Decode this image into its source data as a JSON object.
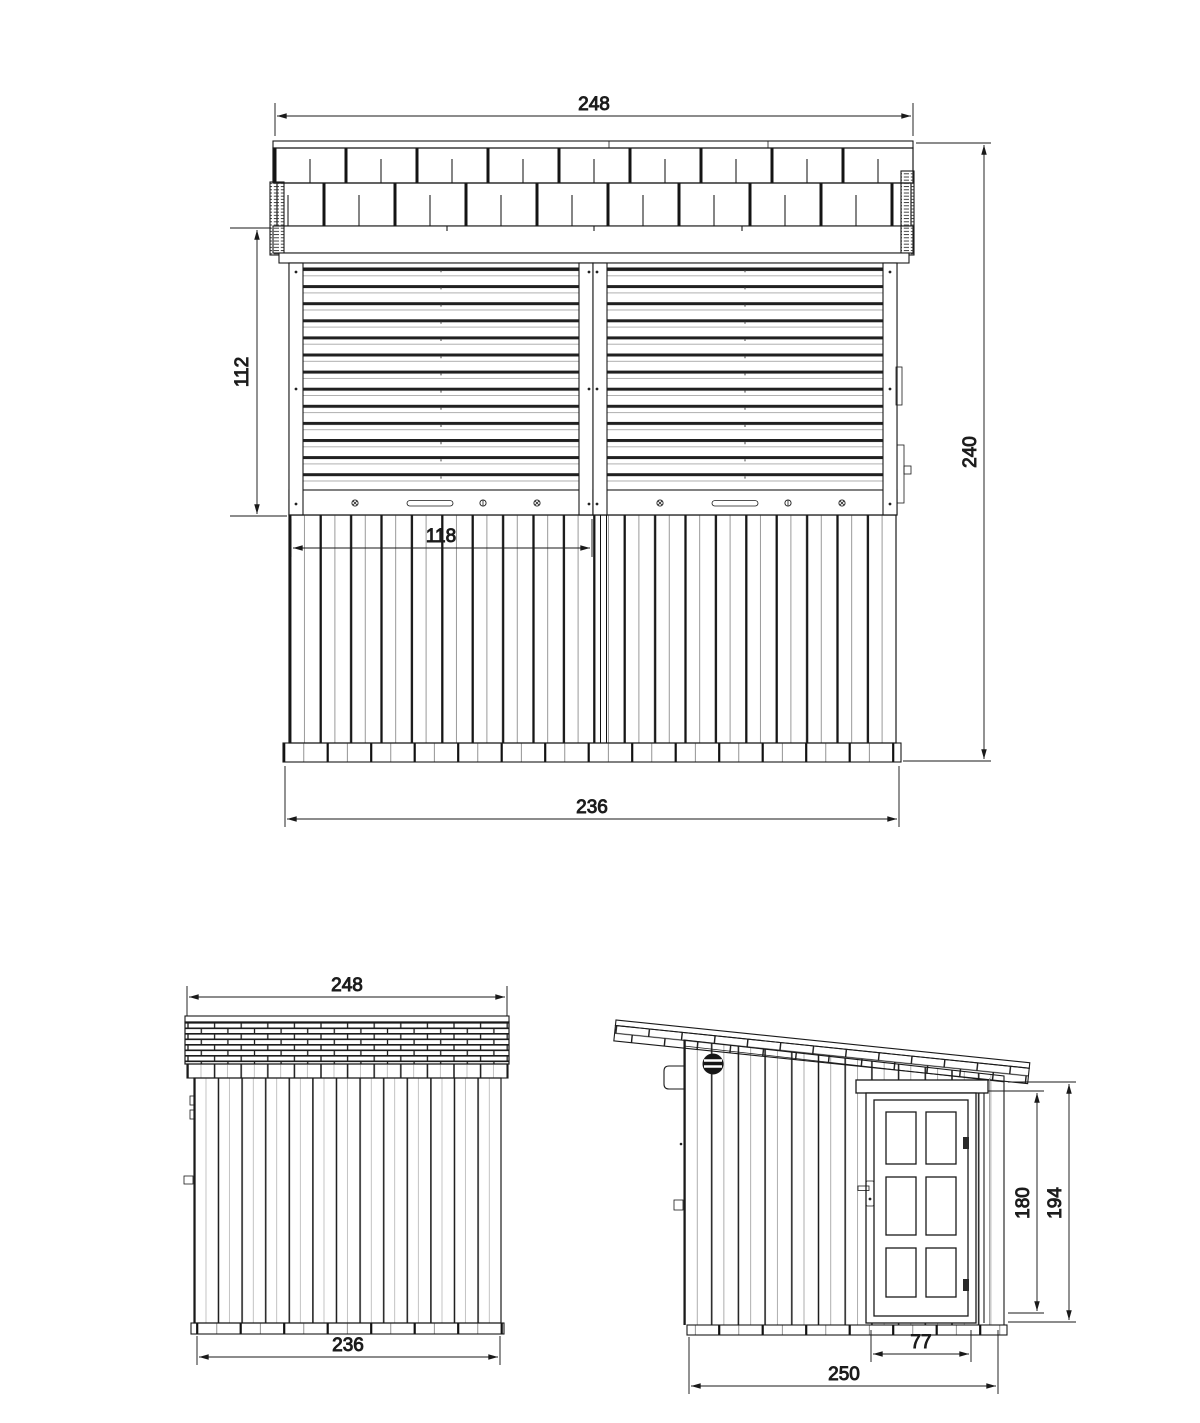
{
  "drawing": {
    "front": {
      "roof_width": "248",
      "shutter_height": "112",
      "overall_height": "240",
      "shutter_width": "118",
      "base_width": "236"
    },
    "rear": {
      "roof_width": "248",
      "base_width": "236"
    },
    "side": {
      "door_height": "180",
      "rear_wall_height": "194",
      "door_width": "77",
      "base_depth": "250"
    }
  },
  "colors": {
    "line": "#1a1a1a",
    "thin_line": "#8a8a8a",
    "background": "#ffffff"
  }
}
